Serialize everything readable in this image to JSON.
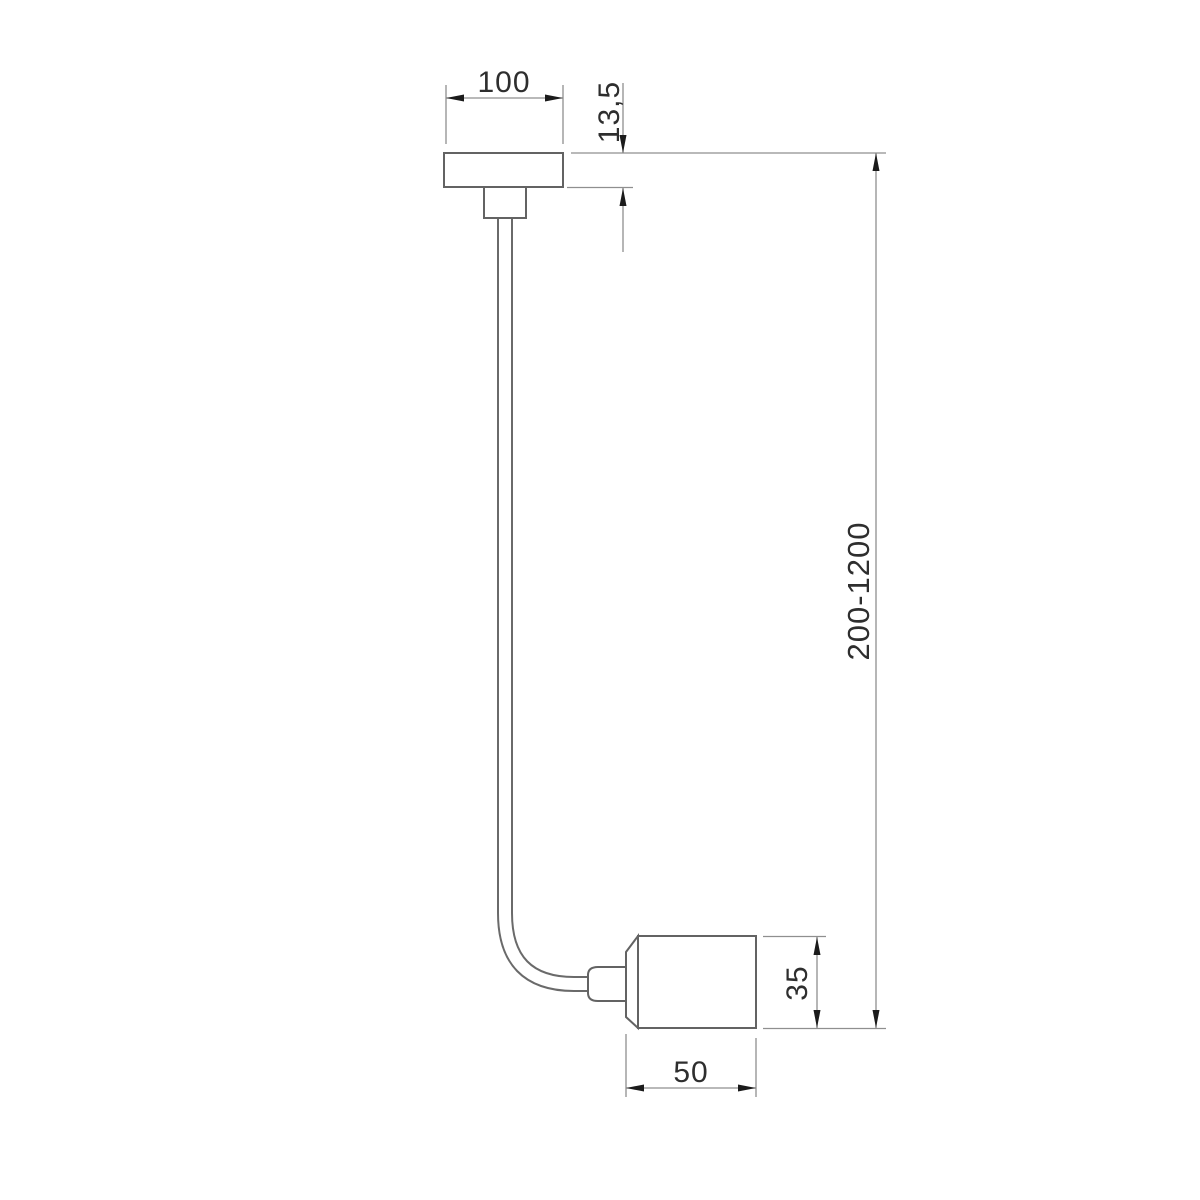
{
  "drawing": {
    "kind": "technical-dimension-drawing",
    "object": "ceiling pendant lamp with cable suspension and cylindrical socket",
    "dimensions": {
      "canopy_width": "100",
      "canopy_thickness": "13,5",
      "suspension_length_range": "200-1200",
      "socket_height": "35",
      "socket_width": "50"
    },
    "colors": {
      "background": "#ffffff",
      "outline": "#636363",
      "dimension_line": "#8f8f8f",
      "arrow": "#1b1b1b",
      "text": "#2e2e2e"
    }
  }
}
